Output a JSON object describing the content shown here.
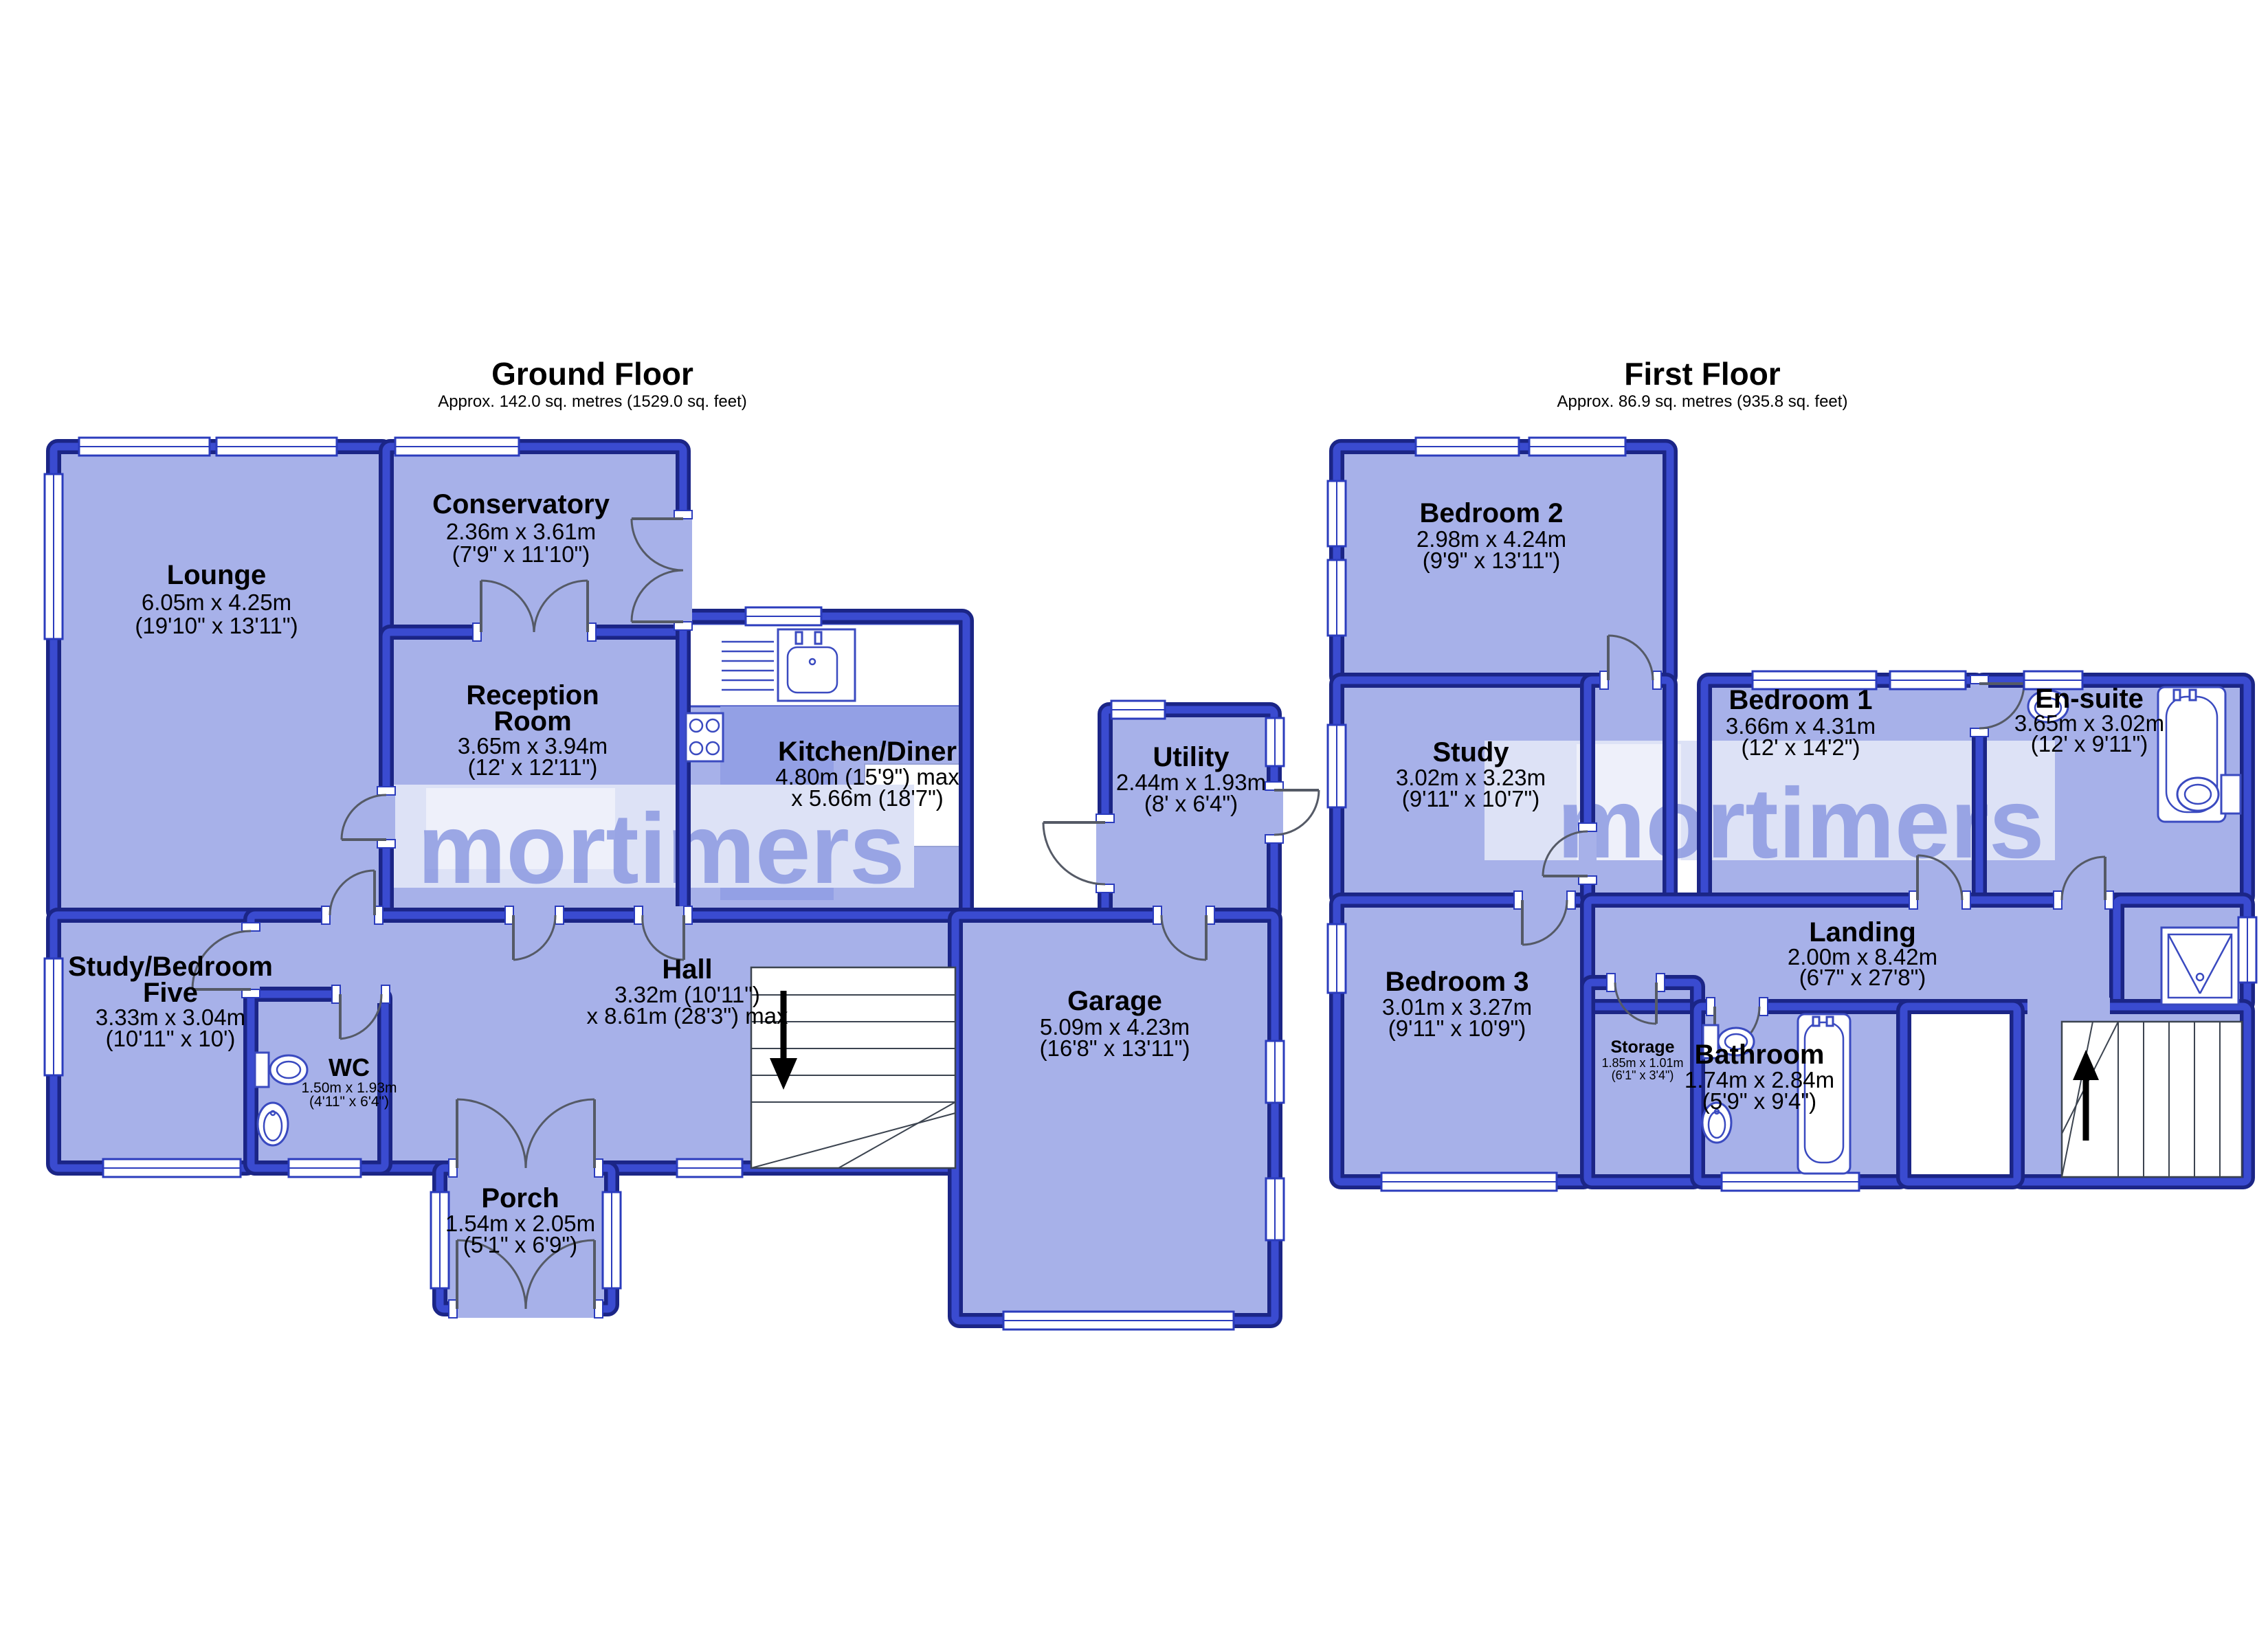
{
  "watermark": {
    "text": "mortimers"
  },
  "colors": {
    "roomFill": "#a7b1e9",
    "kitchenZone": "#93a0e5",
    "wallDark": "#1b2586",
    "wallLight": "#3a4bd0",
    "watermarkBand": "#dde2f6",
    "watermarkBox": "#eef0fa",
    "watermarkText": "#8795e0",
    "fixtureStroke": "#3a4ac0",
    "windowStroke": "#2b3cbd",
    "doorStroke": "#555a66",
    "labelColor": "#000000",
    "background": "#ffffff"
  },
  "ground": {
    "title": "Ground Floor",
    "subtitle": "Approx. 142.0 sq. metres (1529.0 sq. feet)",
    "rooms": {
      "lounge": {
        "name": "Lounge",
        "dims1": "6.05m x 4.25m",
        "dims2": "(19'10\" x 13'11\")"
      },
      "conservatory": {
        "name": "Conservatory",
        "dims1": "2.36m x 3.61m",
        "dims2": "(7'9\" x 11'10\")"
      },
      "reception": {
        "name1": "Reception",
        "name2": "Room",
        "dims1": "3.65m x 3.94m",
        "dims2": "(12' x 12'11\")"
      },
      "kitchen": {
        "name": "Kitchen/Diner",
        "dims1": "4.80m (15'9\") max",
        "dims2": "x 5.66m (18'7\")"
      },
      "utility": {
        "name": "Utility",
        "dims1": "2.44m x 1.93m",
        "dims2": "(8' x 6'4\")"
      },
      "study_bed5": {
        "name1": "Study/Bedroom",
        "name2": "Five",
        "dims1": "3.33m x 3.04m",
        "dims2": "(10'11\" x 10')"
      },
      "wc": {
        "name": "WC",
        "dims1": "1.50m x 1.93m",
        "dims2": "(4'11\" x 6'4\")"
      },
      "hall": {
        "name": "Hall",
        "dims1": "3.32m (10'11\")",
        "dims2": "x 8.61m (28'3\") max"
      },
      "porch": {
        "name": "Porch",
        "dims1": "1.54m x 2.05m",
        "dims2": "(5'1\" x 6'9\")"
      },
      "garage": {
        "name": "Garage",
        "dims1": "5.09m x 4.23m",
        "dims2": "(16'8\" x 13'11\")"
      }
    }
  },
  "first": {
    "title": "First Floor",
    "subtitle": "Approx. 86.9 sq. metres (935.8 sq. feet)",
    "rooms": {
      "bedroom2": {
        "name": "Bedroom 2",
        "dims1": "2.98m x 4.24m",
        "dims2": "(9'9\" x 13'11\")"
      },
      "study": {
        "name": "Study",
        "dims1": "3.02m x 3.23m",
        "dims2": "(9'11\" x 10'7\")"
      },
      "bedroom1": {
        "name": "Bedroom 1",
        "dims1": "3.66m x 4.31m",
        "dims2": "(12' x 14'2\")"
      },
      "ensuite": {
        "name": "En-suite",
        "dims1": "3.65m x 3.02m",
        "dims2": "(12' x 9'11\")"
      },
      "bedroom3": {
        "name": "Bedroom 3",
        "dims1": "3.01m x 3.27m",
        "dims2": "(9'11\" x 10'9\")"
      },
      "storage": {
        "name": "Storage",
        "dims1": "1.85m x 1.01m",
        "dims2": "(6'1\" x 3'4\")"
      },
      "bathroom": {
        "name": "Bathroom",
        "dims1": "1.74m x 2.84m",
        "dims2": "(5'9\" x 9'4\")"
      },
      "landing": {
        "name": "Landing",
        "dims1": "2.00m x 8.42m",
        "dims2": "(6'7\" x 27'8\")"
      }
    }
  }
}
